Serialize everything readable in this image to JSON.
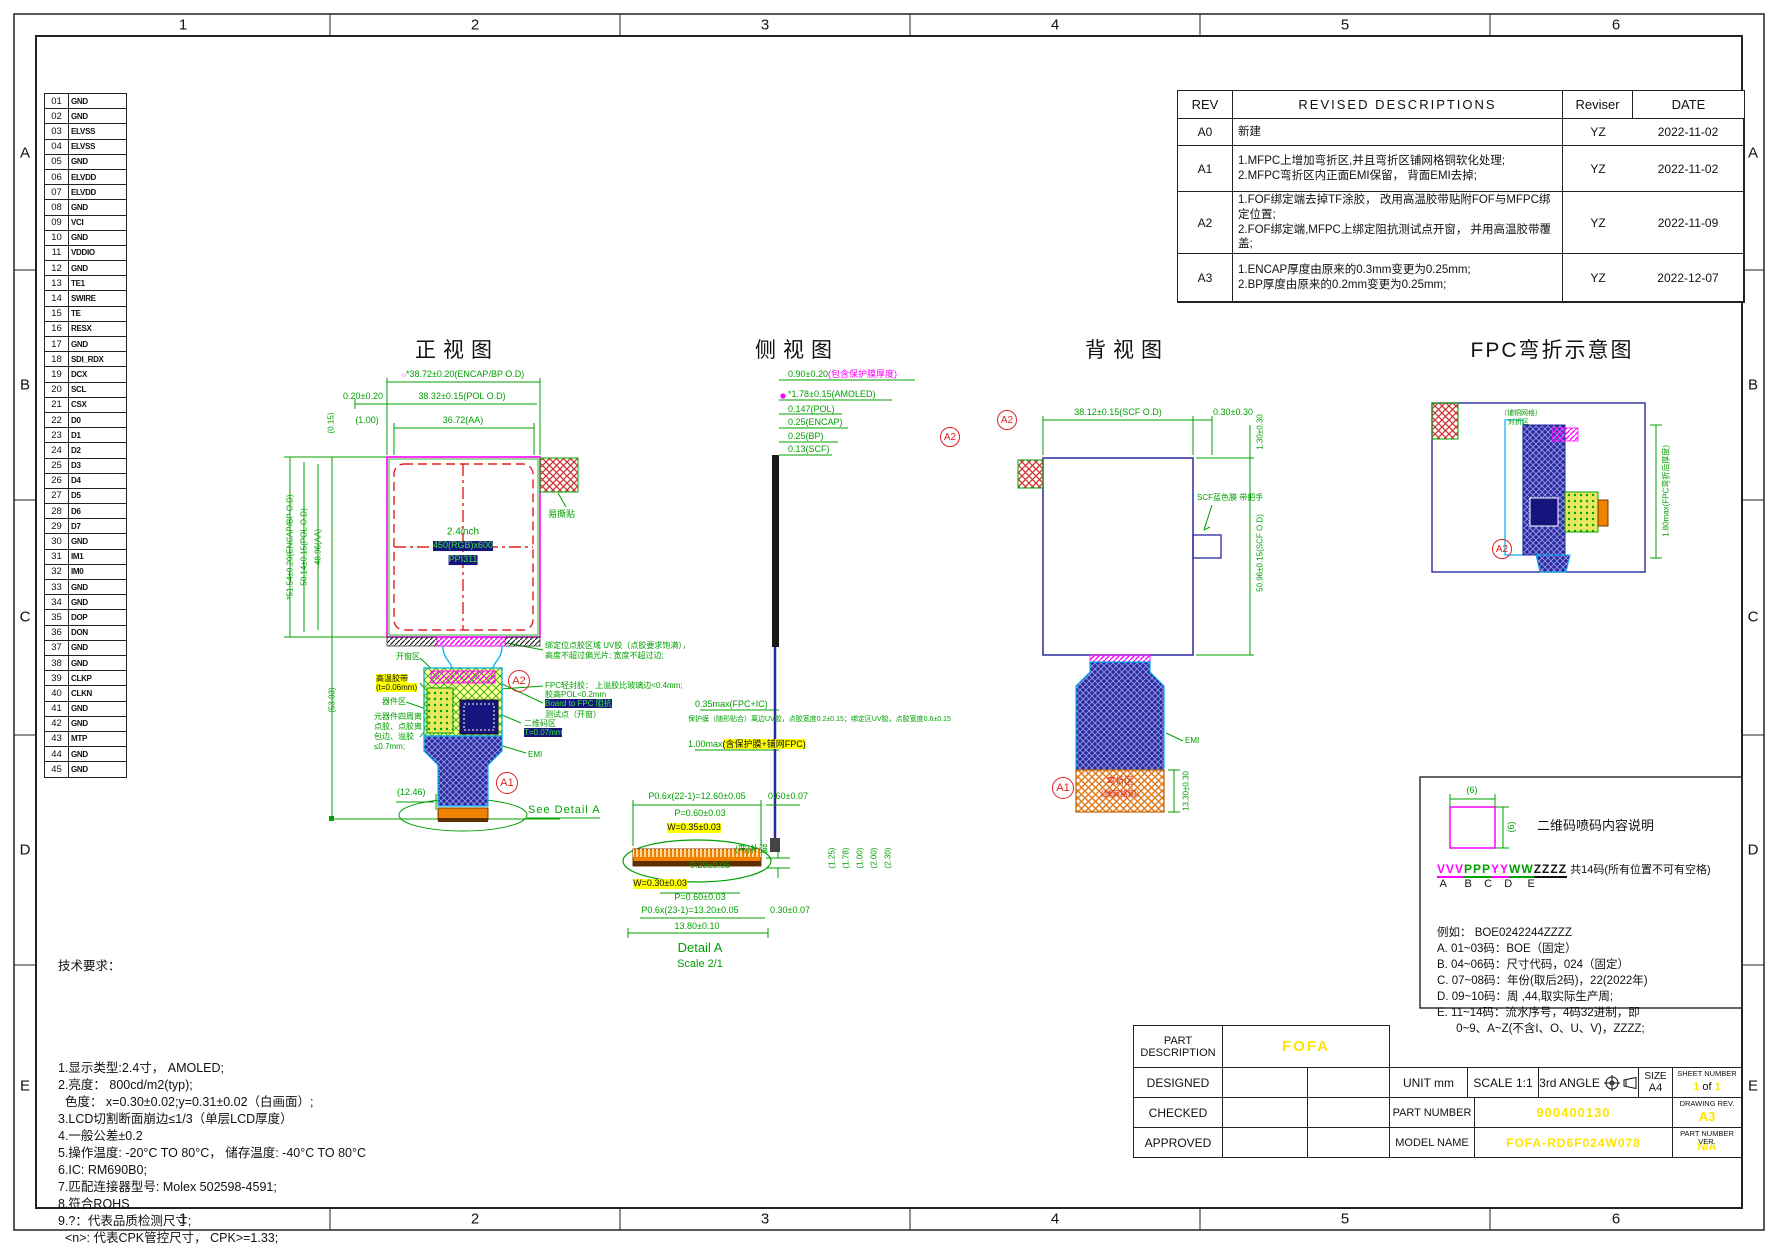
{
  "page": {
    "grid_cols": [
      "1",
      "2",
      "3",
      "4",
      "5",
      "6"
    ],
    "grid_rows": [
      "A",
      "B",
      "C",
      "D",
      "E"
    ]
  },
  "symbols": {
    "qc_circle": "○"
  },
  "pin_table": {
    "pins": [
      {
        "no": "01",
        "name": "GND"
      },
      {
        "no": "02",
        "name": "GND"
      },
      {
        "no": "03",
        "name": "ELVSS"
      },
      {
        "no": "04",
        "name": "ELVSS"
      },
      {
        "no": "05",
        "name": "GND"
      },
      {
        "no": "06",
        "name": "ELVDD"
      },
      {
        "no": "07",
        "name": "ELVDD"
      },
      {
        "no": "08",
        "name": "GND"
      },
      {
        "no": "09",
        "name": "VCI"
      },
      {
        "no": "10",
        "name": "GND"
      },
      {
        "no": "11",
        "name": "VDDIO"
      },
      {
        "no": "12",
        "name": "GND"
      },
      {
        "no": "13",
        "name": "TE1"
      },
      {
        "no": "14",
        "name": "SWIRE"
      },
      {
        "no": "15",
        "name": "TE"
      },
      {
        "no": "16",
        "name": "RESX"
      },
      {
        "no": "17",
        "name": "GND"
      },
      {
        "no": "18",
        "name": "SDI_RDX"
      },
      {
        "no": "19",
        "name": "DCX"
      },
      {
        "no": "20",
        "name": "SCL"
      },
      {
        "no": "21",
        "name": "CSX"
      },
      {
        "no": "22",
        "name": "D0"
      },
      {
        "no": "23",
        "name": "D1"
      },
      {
        "no": "24",
        "name": "D2"
      },
      {
        "no": "25",
        "name": "D3"
      },
      {
        "no": "26",
        "name": "D4"
      },
      {
        "no": "27",
        "name": "D5"
      },
      {
        "no": "28",
        "name": "D6"
      },
      {
        "no": "29",
        "name": "D7"
      },
      {
        "no": "30",
        "name": "GND"
      },
      {
        "no": "31",
        "name": "IM1"
      },
      {
        "no": "32",
        "name": "IM0"
      },
      {
        "no": "33",
        "name": "GND"
      },
      {
        "no": "34",
        "name": "GND"
      },
      {
        "no": "35",
        "name": "DOP"
      },
      {
        "no": "36",
        "name": "DON"
      },
      {
        "no": "37",
        "name": "GND"
      },
      {
        "no": "38",
        "name": "GND"
      },
      {
        "no": "39",
        "name": "CLKP"
      },
      {
        "no": "40",
        "name": "CLKN"
      },
      {
        "no": "41",
        "name": "GND"
      },
      {
        "no": "42",
        "name": "GND"
      },
      {
        "no": "43",
        "name": "MTP"
      },
      {
        "no": "44",
        "name": "GND"
      },
      {
        "no": "45",
        "name": "GND"
      }
    ]
  },
  "revision_table": {
    "h_rev": "REV",
    "h_desc": "REVISED DESCRIPTIONS",
    "h_reviser": "Reviser",
    "h_date": "DATE",
    "rows": [
      {
        "rev": "A0",
        "desc": "新建",
        "reviser": "YZ",
        "date": "2022-11-02"
      },
      {
        "rev": "A1",
        "desc": "1.MFPC上增加弯折区,并且弯折区铺网格铜软化处理;\n2.MFPC弯折区内正面EMI保留， 背面EMI去掉;",
        "reviser": "YZ",
        "date": "2022-11-02"
      },
      {
        "rev": "A2",
        "desc": "1.FOF绑定端去掉TF涂胶， 改用高温胶带贴附FOF与MFPC绑定位置;\n2.FOF绑定端,MFPC上绑定阻抗测试点开窗， 并用高温胶带覆盖;",
        "reviser": "YZ",
        "date": "2022-11-09"
      },
      {
        "rev": "A3",
        "desc": "1.ENCAP厚度由原来的0.3mm变更为0.25mm;\n2.BP厚度由原来的0.2mm变更为0.25mm;",
        "reviser": "YZ",
        "date": "2022-12-07"
      }
    ]
  },
  "views": {
    "front": {
      "title": "正视图",
      "dim_encap_od": "*38.72±0.20(ENCAP/BP O.D)",
      "dim_pol_offset": "0.20±0.20",
      "dim_pol_od": "38.32±0.15(POL O.D)",
      "dim_aa_offset": "(1.00)",
      "dim_aa": "36.72(AA)",
      "dim_topleft": "(0.15)",
      "dim_v_bp": "*51.54±0.20(ENCAP/BP O.D)",
      "dim_v_pol": "50.14±0.15(POL O.D)",
      "dim_v_aa": "48.96(AA)",
      "dim_v_total": "(53.03)",
      "dim_fpc": "(12.46)",
      "panel_line1": "2.4inch",
      "panel_line2": "450(RGB)x600",
      "panel_line3": "PPI311",
      "ann_sticker": "易撕贴",
      "ann_window": "开窗区",
      "ann_tape": "高温胶带",
      "ann_tape2": "(t=0.06mm)",
      "ann_component": "器件区",
      "ann_comp_glue": "元器件四周离点胶、点胶离包边、溢胶≤0.7mm;",
      "ann_uv": "绑定位点胶区域 UV胶（点胶要求饱满），高度不超过偏光片; 宽度不超过边;",
      "ann_seal": "FPC轻封胶： 上溢胶比玻璃边<0.4mm;",
      "ann_seal2": "胶高POL<0.2mm",
      "ann_imp": "Board to FPC 阻抗",
      "ann_imp2": "测试点（开窗）",
      "ann_qr": "二维码区",
      "ann_qr2": "T=0.07mm",
      "ann_emi": "EMI",
      "see_detail": "See Detail A",
      "marker_a1": "A1",
      "marker_a2": "A2"
    },
    "side": {
      "title": "侧视图",
      "stack0a": "0.90±0.20",
      "stack0b": "(包含保护膜厚度)",
      "stack1": "*1.78±0.15(AMOLED)",
      "stack2": "0.147(POL)",
      "stack3": "0.25(ENCAP)",
      "stack4": "0.25(BP)",
      "stack5": "0.13(SCF)",
      "dim_fpc_ic": "0.35max(FPC+IC)",
      "ann_long": "保护膜（随形贴合）离边UV胶，点胶宽度0.2±0.15；绑定区UV胶，点胶宽度0.6±0.15",
      "dim_bend_a": "1.00max",
      "dim_bend_b": "(含保护膜+铺网FPC)",
      "ann_stiffener": "(弯)补强",
      "dim_bottom": "0.29±0.05",
      "marker_a2": "A2"
    },
    "back": {
      "title": "背视图",
      "dim_scf_od": "38.12±0.15(SCF O.D)",
      "dim_offset": "0.30±0.30",
      "dim_v_top": "1.30±0.30",
      "dim_v_scf": "50.96±0.15(SCF O.D)",
      "ann_handle": "SCF蓝色膜 带把手",
      "ann_emi": "EMI",
      "bend_label1": "弯折区",
      "bend_label2": "（铺网格铜）",
      "dim_bend_len": "13.30±0.30",
      "marker_a1": "A1"
    },
    "bend": {
      "title": "FPC弯折示意图",
      "ann_fold1": "（铺铜网格）",
      "ann_fold2": "对折区",
      "dim_thick": "1.80max(FPC弯折后厚度)",
      "marker_a2": "A2"
    },
    "detail": {
      "caption1": "Detail A",
      "caption2": "Scale 2/1",
      "dim_top1": "P0.6x(22-1)=12.60±0.05",
      "dim_top2": "0.60±0.07",
      "dim_p1": "P=0.60±0.03",
      "dim_w1": "W=0.35±0.03",
      "dim_w2": "W=0.30±0.03",
      "dim_p2": "P=0.60±0.03",
      "dim_bot1": "P0.6x(23-1)=13.20±0.05",
      "dim_bot2": "0.30±0.07",
      "dim_bot3": "13.80±0.10",
      "side_dims": [
        "(1.25)",
        "(1.78)",
        "(1.00)",
        "(2.00)",
        "(2.30)"
      ]
    }
  },
  "notes": {
    "title": "技术要求：",
    "lines": [
      "1.显示类型:2.4寸， AMOLED;",
      "2.亮度： 800cd/m2(typ);",
      "  色度： x=0.30±0.02;y=0.31±0.02（白画面）;",
      "3.LCD切割断面崩边≤1/3（单层LCD厚度）",
      "4.一般公差±0.2",
      "5.操作温度: -20°C TO 80°C， 储存温度: -40°C TO 80°C",
      "6.IC: RM690B0;",
      "7.匹配连接器型号: Molex 502598-4591;",
      "8.符合ROHS",
      "9.?：代表品质检测尺寸;",
      "  <n>: 代表CPK管控尺寸， CPK>=1.33;",
      "  *: 代表重要尺寸;  ( ): 代表参考尺寸"
    ]
  },
  "qr_box": {
    "square_dim_w": "(6)",
    "square_dim_h": "(6)",
    "title": "二维码喷码内容说明",
    "code_v": "VVV",
    "code_p": "PPP",
    "code_y": "YY",
    "code_w": "WW",
    "code_z": "ZZZZ",
    "code_suffix": " 共14码(所有位置不可有空格)",
    "code_letters": " A      B    C    D     E",
    "lines": [
      "例如： BOE0242244ZZZZ",
      "A. 01~03码：BOE（固定）",
      "B. 04~06码：尺寸代码，024（固定）",
      "C. 07~08码：年份(取后2码)，22(2022年)",
      "D. 09~10码：周 ,44,取实际生产周;",
      "E. 11~14码：流水序号，4码32进制，即",
      "      0~9、A~Z(不含I、O、U、V)，ZZZZ;"
    ]
  },
  "title_block": {
    "part_description_label": "PART\nDESCRIPTION",
    "part_description_value": "FOFA",
    "designed": "DESIGNED",
    "checked": "CHECKED",
    "approved": "APPROVED",
    "unit": "UNIT mm",
    "scale": "SCALE 1:1",
    "angle": "3rd ANGLE",
    "size_label": "SIZE",
    "size_value": "A4",
    "sheet_label": "SHEET NUMBER",
    "sheet_1": "1",
    "sheet_of": "of",
    "sheet_2": "1",
    "part_number_label": "PART NUMBER",
    "part_number_value": "900400130",
    "drawing_rev_label": "DRAWING REV.",
    "drawing_rev_value": "A3",
    "model_name_label": "MODEL NAME",
    "model_name_value": "FOFA-RD6F024W078",
    "part_number_ver_label": "PART NUMBER VER.",
    "part_number_ver_value": "N/A"
  }
}
